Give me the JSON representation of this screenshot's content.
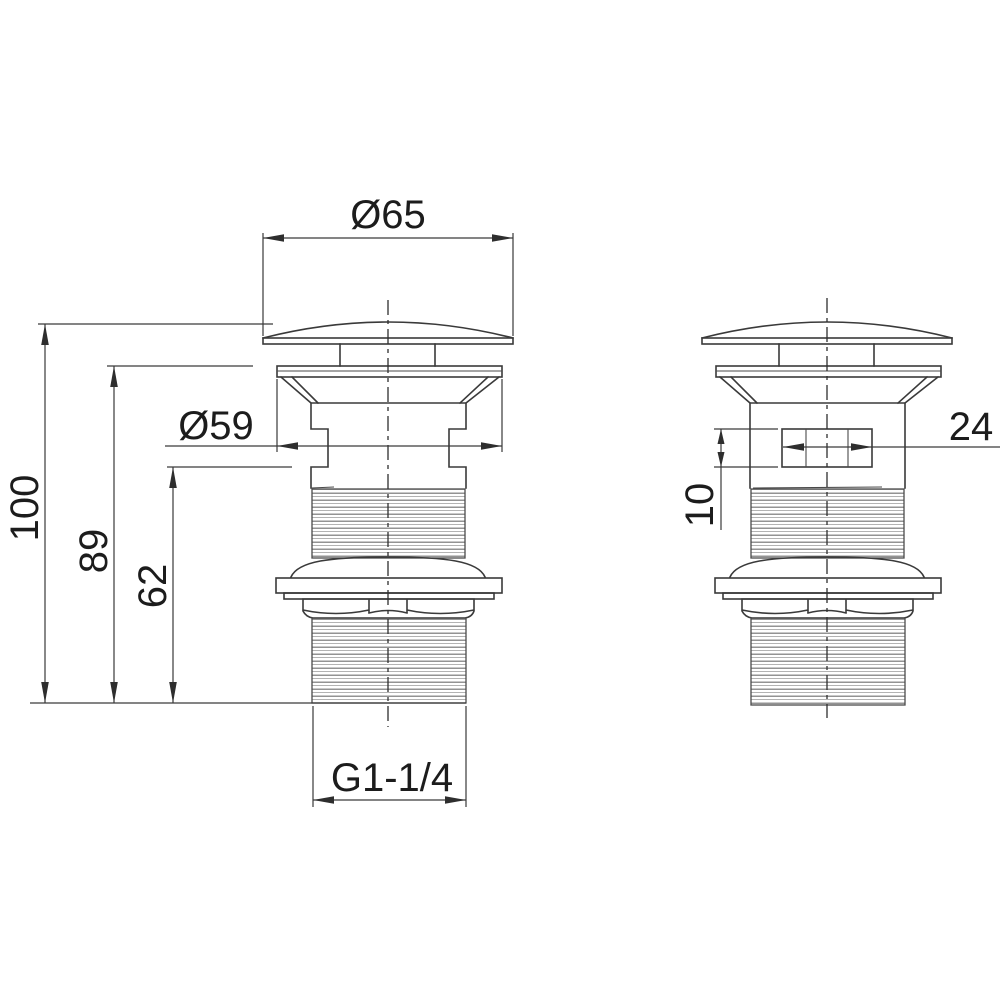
{
  "drawing": {
    "type": "technical-dimension-drawing",
    "subject": "basin waste plug with overflow - two orthographic views",
    "colors": {
      "background": "#ffffff",
      "line": "#3a3a3a",
      "thread_line": "#8a8a8a",
      "text": "#1c1c1c"
    },
    "dimensions": {
      "cap_diameter": "Ø65",
      "flange_diameter": "Ø59",
      "total_height": "100",
      "height_below_cap": "89",
      "height_to_overflow": "62",
      "thread_size": "G1-1/4",
      "overflow_slot_width": "24",
      "overflow_slot_height": "10"
    }
  }
}
